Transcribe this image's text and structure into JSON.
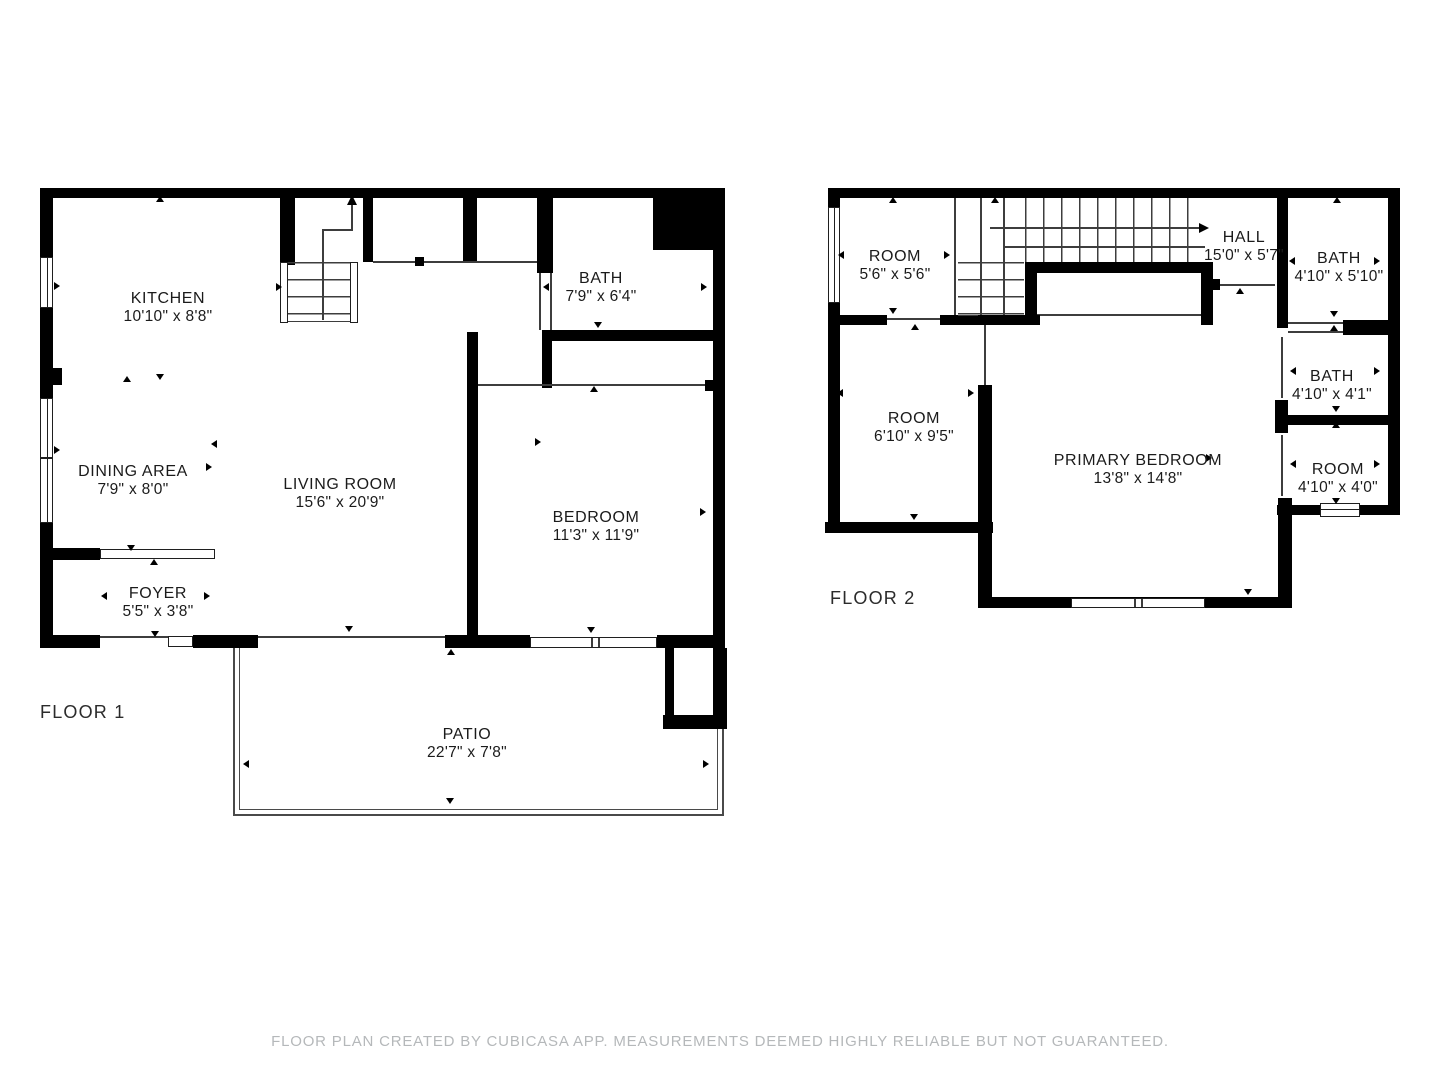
{
  "colors": {
    "wall": "#000000",
    "thin_line": "#3d3d3d",
    "text": "#1b1b1b",
    "footer_text": "#b5b8ba",
    "background": "#ffffff"
  },
  "floor1": {
    "label": "FLOOR 1",
    "rooms": [
      {
        "id": "kitchen",
        "name": "KITCHEN",
        "dims": "10'10\" x 8'8\""
      },
      {
        "id": "bath",
        "name": "BATH",
        "dims": "7'9\" x 6'4\""
      },
      {
        "id": "dining-area",
        "name": "DINING AREA",
        "dims": "7'9\" x 8'0\""
      },
      {
        "id": "living-room",
        "name": "LIVING ROOM",
        "dims": "15'6\" x 20'9\""
      },
      {
        "id": "bedroom",
        "name": "BEDROOM",
        "dims": "11'3\" x 11'9\""
      },
      {
        "id": "foyer",
        "name": "FOYER",
        "dims": "5'5\" x 3'8\""
      },
      {
        "id": "patio",
        "name": "PATIO",
        "dims": "22'7\" x 7'8\""
      }
    ]
  },
  "floor2": {
    "label": "FLOOR 2",
    "rooms": [
      {
        "id": "room-a",
        "name": "ROOM",
        "dims": "5'6\" x 5'6\""
      },
      {
        "id": "hall",
        "name": "HALL",
        "dims": "15'0\" x 5'7\""
      },
      {
        "id": "bath-upper",
        "name": "BATH",
        "dims": "4'10\" x 5'10\""
      },
      {
        "id": "room-b",
        "name": "ROOM",
        "dims": "6'10\" x 9'5\""
      },
      {
        "id": "bath-lower",
        "name": "BATH",
        "dims": "4'10\" x 4'1\""
      },
      {
        "id": "primary-bedroom",
        "name": "PRIMARY BEDROOM",
        "dims": "13'8\" x 14'8\""
      },
      {
        "id": "room-c",
        "name": "ROOM",
        "dims": "4'10\" x 4'0\""
      }
    ]
  },
  "footer": "FLOOR PLAN CREATED BY CUBICASA APP. MEASUREMENTS DEEMED HIGHLY RELIABLE BUT NOT GUARANTEED."
}
